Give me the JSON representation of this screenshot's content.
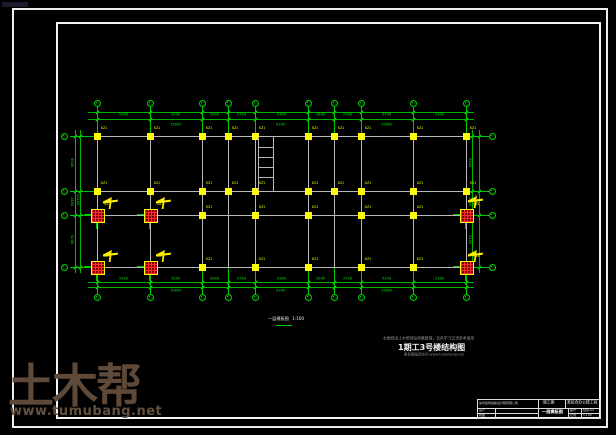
{
  "watermark": {
    "logo": "土木帮",
    "site": "www.tumubang.net"
  },
  "plan": {
    "v_axes": [
      97,
      150,
      202,
      228,
      255,
      308,
      334,
      361,
      413,
      466
    ],
    "h_axes": [
      136,
      191,
      215,
      267
    ],
    "yellow_columns": [
      [
        97,
        136
      ],
      [
        150,
        136
      ],
      [
        202,
        136
      ],
      [
        228,
        136
      ],
      [
        255,
        136
      ],
      [
        308,
        136
      ],
      [
        334,
        136
      ],
      [
        361,
        136
      ],
      [
        413,
        136
      ],
      [
        466,
        136
      ],
      [
        97,
        191
      ],
      [
        150,
        191
      ],
      [
        202,
        191
      ],
      [
        228,
        191
      ],
      [
        255,
        191
      ],
      [
        308,
        191
      ],
      [
        334,
        191
      ],
      [
        361,
        191
      ],
      [
        413,
        191
      ],
      [
        466,
        191
      ],
      [
        202,
        215
      ],
      [
        255,
        215
      ],
      [
        308,
        215
      ],
      [
        361,
        215
      ],
      [
        413,
        215
      ],
      [
        202,
        267
      ],
      [
        255,
        267
      ],
      [
        308,
        267
      ],
      [
        361,
        267
      ],
      [
        413,
        267
      ]
    ],
    "red_columns": [
      [
        97,
        215
      ],
      [
        150,
        215
      ],
      [
        466,
        215
      ],
      [
        97,
        267
      ],
      [
        150,
        267
      ],
      [
        466,
        267
      ]
    ],
    "flags": [
      {
        "x": 103,
        "y": 197
      },
      {
        "x": 156,
        "y": 197
      },
      {
        "x": 103,
        "y": 250
      },
      {
        "x": 156,
        "y": 250
      },
      {
        "x": 468,
        "y": 196
      },
      {
        "x": 468,
        "y": 250
      }
    ],
    "stair": {
      "x1": 258,
      "x2": 273,
      "y_top": 137,
      "y_bottom": 191,
      "rungs": [
        147,
        157,
        167,
        177
      ]
    },
    "dims_top": [
      "5300",
      "5200",
      "2600",
      "2700",
      "5300",
      "2600",
      "2700",
      "5200",
      "5300"
    ],
    "dims_top_group": [
      {
        "from": 97,
        "to": 255,
        "label": "15800"
      },
      {
        "from": 255,
        "to": 308,
        "label": "5300"
      },
      {
        "from": 308,
        "to": 466,
        "label": "15800"
      }
    ],
    "dims_bottom": [
      "5300",
      "5200",
      "2600",
      "2700",
      "5300",
      "2600",
      "2700",
      "5200",
      "5300"
    ],
    "dims_bottom_group": [
      {
        "from": 97,
        "to": 255,
        "label": "15800"
      },
      {
        "from": 255,
        "to": 308,
        "label": "5300"
      },
      {
        "from": 308,
        "to": 466,
        "label": "15800"
      }
    ],
    "dims_left": [
      "5500",
      "2400",
      "5200"
    ],
    "dims_left_group": [
      {
        "from": 136,
        "to": 267,
        "label": "13100"
      }
    ],
    "dims_right": [
      "5500",
      "2400",
      "5200"
    ],
    "dims_right_group": [
      {
        "from": 136,
        "to": 267,
        "label": "13100"
      }
    ],
    "column_label": "KZ1",
    "red_column_label": "GZ1"
  },
  "plan_title": {
    "text": "一层模板图",
    "scale": "1:100"
  },
  "caption": {
    "line1": "本图纸由土木帮网站收集整理，仅供学习交流参考使用",
    "line2": "1期工3号楼结构图",
    "line3": "更多图纸请访问 www.tumubang.net"
  },
  "title_block": {
    "company": "某市建筑勘察设计院有限公司",
    "stage": "施工图",
    "project": "某综合办公楼工程",
    "left_rows": [
      {
        "label": "设计"
      },
      {
        "label": "制图"
      }
    ],
    "drawing_name": "一层模板图",
    "meta": [
      {
        "label": "图号",
        "value": "结施-03"
      },
      {
        "label": "比例",
        "value": "1:100"
      }
    ]
  },
  "colors": {
    "cad_green": "#00c800",
    "cad_yellow": "#ffff00",
    "cad_grey": "#b8b8b8",
    "section_red": "#7a0000",
    "watermark_brown": "#5f4a39"
  }
}
